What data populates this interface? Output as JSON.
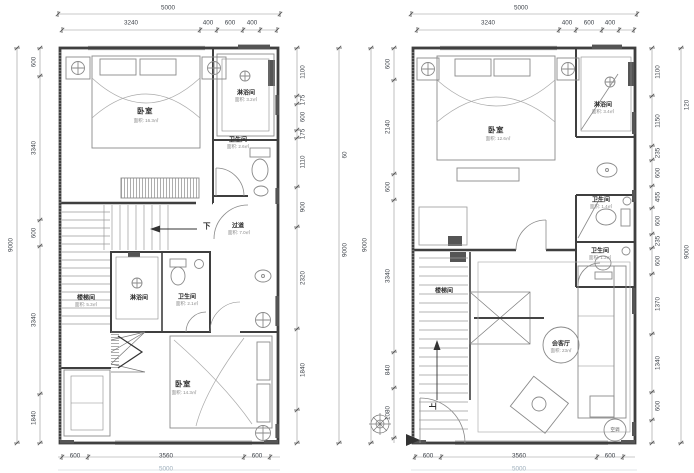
{
  "plans": [
    {
      "id": "left-unit",
      "dims": {
        "top_total": "5000",
        "top": [
          "3240",
          "400",
          "600",
          "400"
        ],
        "left_total": "9000",
        "left": [
          "600",
          "3340",
          "600",
          "3340",
          "1840"
        ],
        "right": [
          "1100",
          "175",
          "600",
          "175",
          "1110",
          "900",
          "2320",
          "1840"
        ],
        "right_outer_a": "60",
        "right_outer_b": "9000",
        "bottom": [
          "600",
          "3560",
          "600"
        ],
        "bottom_total": "5000"
      },
      "rooms": [
        {
          "name": "卧室",
          "area": "面积: 16.3㎡"
        },
        {
          "name": "淋浴间",
          "area": "面积: 3.2㎡"
        },
        {
          "name": "卫生间",
          "area": "面积: 2.6㎡"
        },
        {
          "name": "过道",
          "area": "面积: 7.0㎡"
        },
        {
          "name": "楼梯间",
          "area": "面积: 5.3㎡"
        },
        {
          "name": "淋浴间",
          "area": ""
        },
        {
          "name": "卫生间",
          "area": "面积: 2.1㎡"
        },
        {
          "name": "卧室",
          "area": "面积: 14.3㎡"
        }
      ],
      "annotations": {
        "down": "下"
      }
    },
    {
      "id": "right-unit",
      "dims": {
        "top_total": "5000",
        "top": [
          "3240",
          "400",
          "600",
          "400"
        ],
        "left_total": "9000",
        "left": [
          "600",
          "2140",
          "600",
          "3340",
          "840",
          "1080"
        ],
        "right": [
          "1100",
          "1150",
          "235",
          "600",
          "455",
          "600",
          "235",
          "600",
          "1370",
          "1340",
          "600"
        ],
        "right_outer_a": "120",
        "right_outer_b": "9000",
        "bottom": [
          "600",
          "3560",
          "600"
        ],
        "bottom_total": "5000"
      },
      "rooms": [
        {
          "name": "卧室",
          "area": "面积: 12.6㎡"
        },
        {
          "name": "淋浴间",
          "area": "面积: 3.4㎡"
        },
        {
          "name": "卫生间",
          "area": "面积: 1.4㎡"
        },
        {
          "name": "卫生间",
          "area": "面积: 1.2㎡"
        },
        {
          "name": "楼梯间",
          "area": ""
        },
        {
          "name": "会客厅",
          "area": "面积: 23㎡"
        }
      ],
      "annotations": {
        "up": "上",
        "ac": "空调"
      }
    }
  ]
}
